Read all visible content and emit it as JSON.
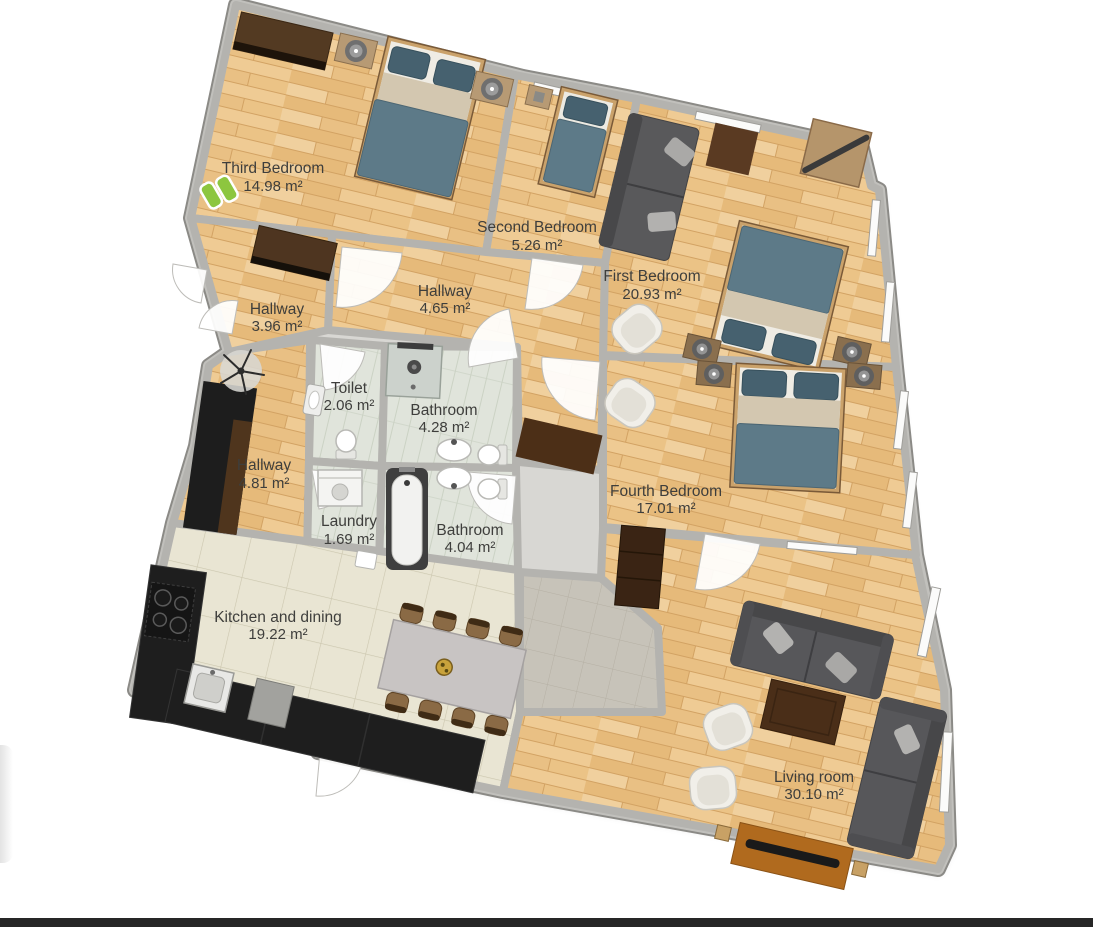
{
  "page": {
    "background": "#ffffff",
    "bottom_bar_color": "#262626"
  },
  "floorplan": {
    "rooms": [
      {
        "id": "third-bedroom",
        "name": "Third Bedroom",
        "area": "14.98 m²"
      },
      {
        "id": "second-bedroom",
        "name": "Second Bedroom",
        "area": "5.26 m²"
      },
      {
        "id": "first-bedroom",
        "name": "First Bedroom",
        "area": "20.93 m²"
      },
      {
        "id": "hallway-top",
        "name": "Hallway",
        "area": "4.65 m²"
      },
      {
        "id": "hallway-left",
        "name": "Hallway",
        "area": "3.96 m²"
      },
      {
        "id": "toilet",
        "name": "Toilet",
        "area": "2.06 m²"
      },
      {
        "id": "bathroom-upper",
        "name": "Bathroom",
        "area": "4.28 m²"
      },
      {
        "id": "hallway-lower",
        "name": "Hallway",
        "area": "4.81 m²"
      },
      {
        "id": "laundry",
        "name": "Laundry",
        "area": "1.69 m²"
      },
      {
        "id": "bathroom-lower",
        "name": "Bathroom",
        "area": "4.04 m²"
      },
      {
        "id": "fourth-bedroom",
        "name": "Fourth Bedroom",
        "area": "17.01 m²"
      },
      {
        "id": "kitchen",
        "name": "Kitchen and dining",
        "area": "19.22 m²"
      },
      {
        "id": "living-room",
        "name": "Living room",
        "area": "30.10 m²"
      }
    ],
    "colors": {
      "wood_floor": "#ebc386",
      "bath_tile": "#e0e4db",
      "kitchen_tile": "#e9e5d3",
      "entry_tile": "#c7c3b9",
      "wall": "#b4b3af",
      "wall_edge": "#8b8a86",
      "label_text": "#3e3e3c",
      "bed_blanket": "#5d7a88",
      "bed_pillow": "#46616f",
      "bed_sheet": "#d3c7b0",
      "sofa_grey": "#57575a",
      "counter_black": "#1e1e1e",
      "wardrobe_brown": "#4e3520",
      "accent_green": "#8dc63f",
      "tv_console_orange": "#b06a1e"
    }
  }
}
